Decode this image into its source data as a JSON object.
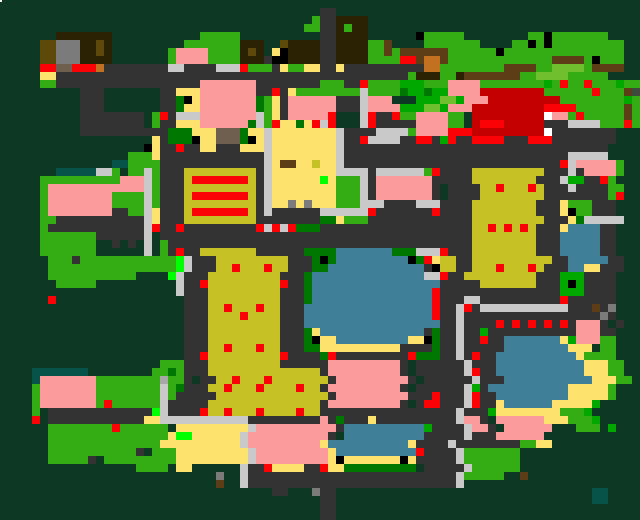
{
  "map": {
    "title": "pixel-town-map",
    "canvas": {
      "width": 640,
      "height": 520,
      "cell": 8,
      "cols": 80,
      "rows": 65
    },
    "palette": {
      ".": {
        "name": "terrain-dark-pine",
        "color": "#0d3824"
      },
      "r": {
        "name": "road-asphalt",
        "color": "#333333"
      },
      "s": {
        "name": "sidewalk-light",
        "color": "#c9c9c9"
      },
      "n": {
        "name": "sidewalk-mid",
        "color": "#a8a8a8"
      },
      "p": {
        "name": "building-pink-roof",
        "color": "#fb9b9b"
      },
      "g": {
        "name": "grass-bright",
        "color": "#33ad13"
      },
      "G": {
        "name": "tree-green",
        "color": "#00a800"
      },
      "d": {
        "name": "tree-dark-green",
        "color": "#007700"
      },
      "L": {
        "name": "marker-lime",
        "color": "#00ff00"
      },
      "A": {
        "name": "grass-light",
        "color": "#6fbf2e"
      },
      "o": {
        "name": "building-khaki",
        "color": "#c6c225"
      },
      "y": {
        "name": "sand-pale-yellow",
        "color": "#fde26e"
      },
      "b": {
        "name": "water-steel-blue",
        "color": "#3f7f97"
      },
      "R": {
        "name": "marker-red",
        "color": "#fb0207"
      },
      "D": {
        "name": "building-dark-red",
        "color": "#c50000"
      },
      "k": {
        "name": "black",
        "color": "#000000"
      },
      "w": {
        "name": "white",
        "color": "#ffffff"
      },
      "B": {
        "name": "building-dark-brown",
        "color": "#2b2103"
      },
      "m": {
        "name": "dirt-brown",
        "color": "#5d3d15"
      },
      "t": {
        "name": "roof-tan",
        "color": "#c1711f"
      },
      "h": {
        "name": "roof-taupe",
        "color": "#6f5f4e"
      },
      "q": {
        "name": "stone-gray",
        "color": "#7b7b7b"
      },
      "T": {
        "name": "pond-teal",
        "color": "#075249"
      },
      "O": {
        "name": "roof-dark-olive",
        "color": "#5d4a0b"
      },
      "v": {
        "name": "gray-green",
        "color": "#3d4b3d"
      }
    },
    "grid": [
      "................................................................................",
      "........................................rr......................................",
      ".......................................grrBBBB..................................",
      "......................................ggrrBgBB..................................",
      ".......BBBBBBB...........ggggg..........rrBBBB......kggggg........ggkggggggg....",
      ".....OOqqqBBOB.........gggggggBBB..OBBBBrrBBBBggm....ggggggg....ggkgkggggggggg..",
      ".....OOqqqBBOB.......gppppggggBOB.ykBBBBrrBBBBggmgmmmmmmggggggkggggggggggggggg..",
      ".....OOqqqBBBB.......gppppggggBBBrkkBBBBrrBBBBggggRRmttmgggggggggggggmmmmgkggg..",
      ".....RRhhRRRtrrrrrrrrssrrrrsssRgggryggyyrryrrrrrrrrrrttggggggggmmmmggAAAAgmmmm..",
      ".....yyrrrrrrrrrrrrrrrrrrrrrrrrrrrrrrrrrrrrrrrrrrrrgBBBggBmmmmmmmggAAAAggggg..",
      ".....ggrrrrrrrrrrrrrrrrrrppppppprrrrrrrrgggrrRggggGGGgggppppggggggggGgRggRgggGgg",
      "..........rrr.......rryyyppppppprrRryggggggggsggggdGGdGGppppDDDDDDDDggggggRgggmv",
      "..........rrr.......rrdkypppppppdgyrpppppprrrsppp003GGGAAGpppDDDDDDDDDggggggggGgmg",
      "..........rrr.......rrdyypppppppdgyrpppppprrrsppppGGGAAGpppDDDDDDDDDRRRRggggggmg",
      "..........rrrrrrrr.gRrssspppppppsgyrpppppR...sRrrRggppppgg.DDDDDDDDDwppgRgggggmg",
      "..........rrrrrrrr.grryyyppppppdsgRyydyRsR...sRrrrrrppppgg.DRRRDDDDDrrrssssgggRg",
      "..........rrrrrrrrrrrdddyyyhhhdyysyyyyyyyysrrrrssssgppppRRRDDDDDDDDDwrrrrrrrr...",
      "...................yrdddkyyhhhdkysyyyyyyyysrrRssssrrRRrGRrrRRRRrrrRRRrrrrrrrr...",
      "..................kyrrRrryyrrryyysyyyyyyyysrrrrrrrrrrrrrrrrrrrrrrrrrrrrrrrrr...",
      "................gggyrrrrrrrrrrrrrsyyyyyyyysrrrrrrrrrrrrrrrrrrrrrrrrrrrrsssss...",
      "..............TTggggrrrrrrrrrrrrrsymmyyoyysrrrrrrrrrrrrrrrrrrrrrrrrrrrRspppppg...",
      ".......TTTTTssg.ggsgrrrooooooooorsyyyyyyyyssssrssssssgRrrrrooooooooorrrsrppppg...",
      ".....ggggggggggpppsgrrroRRRRRRRorsyyyyyyLygggsrppppppprrrrroooooooorrrsGGrrRg...",
      ".....gppppppppppppsgrrrooooooooorsyyyyyyyygggsrpppppppr rrrrooRoooRorrrsrrrrgg...",
      ".....gppppppppggggsgrrroRRRRRRRorsyyyyyyyygggsrpppppppr rrrroooooooorrrrrrrrgR...",
      ".....gppppppppggggsgrrrooooooooorsyyqyqyyygggsssrrrrsssrrrroooooooorrrygggrrr...",
      ".....gpppppppprrggsyrrroRRRRRRRorsrrrrrrssssssRrrrrrrrRrrrroooooooorrrykggrrr...",
      ".....ggrrrrrrrrrrrsyrrrooooooooorrrrrrrrddygggrrrrrrrrrrrrrooooooooorrrydsssss...",
      ".....grrrrrrrrrrrrsRrrRrrrrrrrrrRsRsRdddrrrrrrrrrrrrrrrrrrrooRoRoRorrrybbbbrr...",
      ".....gggggggrrrrrrs.rrrrrrrrrrrrrrrrrrrrrrrrrrrrrrrrrrrrrrroooooooorrrbbbbbrr...",
      ".....ggggggg..r.r.s.grrrrrrrrrrrrrrrrrrrrrrrrrrrrrrrrrrrrrroooooooorrrbbbbbrr...",
      ".....ggggggg......s.grRrrooooooorrrrrrddddbbbbbbbdddsssRrrroooooooorrrbbbbbrr...",
      "......gggrggggggggggggLsrrrooooooooorrrdkdbbbbbbbbbkdRyoorroooooooooorrbbbbbrr...",
      "......ggggggggggggggggLsrrrooRoooRoorrrddbbbbbbbbbbbbrkoorroooRoooRorrrbbyyrrr...",
      "......ggggggggggg....LsrrrooooooooorrrdbbbbbbbbbbbbbbssRrrooooooooorrrGGGrrrr...",
      ".......ggggg..........srrRoooooooooRrrdbbbbbbbbbbbbbbbbrrrrrooooooorrrGkGrrrr...",
      "......................srrrooooooooorrrdbbbbbbbbbbbbbbbRrrrrrrrrrrrrrrrGGGrrrr...",
      "......R................rrrooooooooorrrdbbbbbbbbbbbbbbbRrrrssrrrrrrrrrrRrrrrrr...",
      ".......................rrrooRoooRoorrrbbbbbbbbbbbbbbbbRrrsRrsssssssssssrrrmrq...",
      ".......................rrrooooRoooorrrbbbbbbbbbbbbbbbbRrrsrrrrrrrrrrrrrrrrrqr...",
      ".......................rrrooooooooorrrbbbbbbbbbbbbbbbbbrrsrrrrRrRrRrRrRrpppr r...",
      ".......................rrrooooooooorrrdybbbbbbbbbbbbbrdrrsrrGrrrrrrrrrrrppprr...",
      ".......................rrrooooooooorrrdkyybbbbbbbbbyykdrrsrrRrrbbbbbbbyGpppgg...",
      ".......................rrrooRoooRoorrrddyyyyyyyyyyrrrrdrrsrrrrrbbbbbbbbyyy.gg...",
      ".......................rrRoooooooooRrrrrdRrrrrrrrrrRdddrrsrRrrbbbbbbbbbbygggg...",
      "....................gggrrrooooooooorrrrrrpppppppppr rrrrrrsrrrbbbbbbbbbbbyyygg...",
      "....TTTTTTT........ggdgrrroooooooooooooorpppppppppr rrrrrrsRrrbbbbbbbbbbbyyygg...",
      "....Tpppppppggggggggnggr rrooRoooRooooooorpppppppppr rrrrrrsrrrbbbbbbbbbbbyyygg...",
      "....gpppppppggggggggsgdrrrooRoooRooooRoorpppppppppr rrrrrrsGrbbbbbbbbbbyyyyyg....",
      "....gpppppppggggggggsgrrrrroooooooooooooorppppppppprrrRrrrsRrrbbbbbbbbbyyyyyg....",
      "....gpppppppgRggggggsrrrrroooooooooooooorpppppppppr rRRrrrsRrrybbbbbbyyyyyG......",
      "....g.rrrrrrrrrrrrrLsrrrrRooRoooRooooRoorrrrrrrrrrrrrrrrrsrrrGyyyyyyyygggG......",
      "....R.rrrrrrrrrrrryysssssssssssrrrrrrrrrprdrrryrrrrrrrrrrsppr ppppppyyygggG......",
      "......ggggggggRgggggg yyyyyyyyyspppppppppprbbbbbbbbbbGrrrrsppr pppppp...ggg.G.....",
      "......gggggggggggggggyLLyyyyyysppppppppppr bbbbbbbbbbrrrrrsrrrpppppp.............",
      "......ggggggggggggggyyyyyyyyyyspppppppppybbbbbbbbbbyrrrrsrrrrrrrrggyy..........",
      "......gggggggggggr gggyyyyyyyyyspppppppppybbbbbbbbbbRrrrrsggggggg...............",
      "......gggggr gggggggggyyyyyyyyyspppppppppykyyyyyyykyrrrrrsggggggg...............",
      ".................gggg.yy......srrRyyyyrrRyyddddddddd rrrrrsgggggg................",
      "...........................q..srrrrrrrrrrrrrrrrrrrrrrrrrrsggggg..m..............",
      "...........................m..srrrrrrrrrrrrrrrrrrrrrrrrrrs......................",
      "..................................rr...qrr................................TT....",
      "........................................rr................................TT....",
      "........................................rr......................................",
      "........................................rr......................................"
    ],
    "extras": [
      {
        "x": 0,
        "y": 0,
        "w": 2,
        "h": 2,
        "color": "#ffffff",
        "name": "white-dot"
      }
    ]
  }
}
